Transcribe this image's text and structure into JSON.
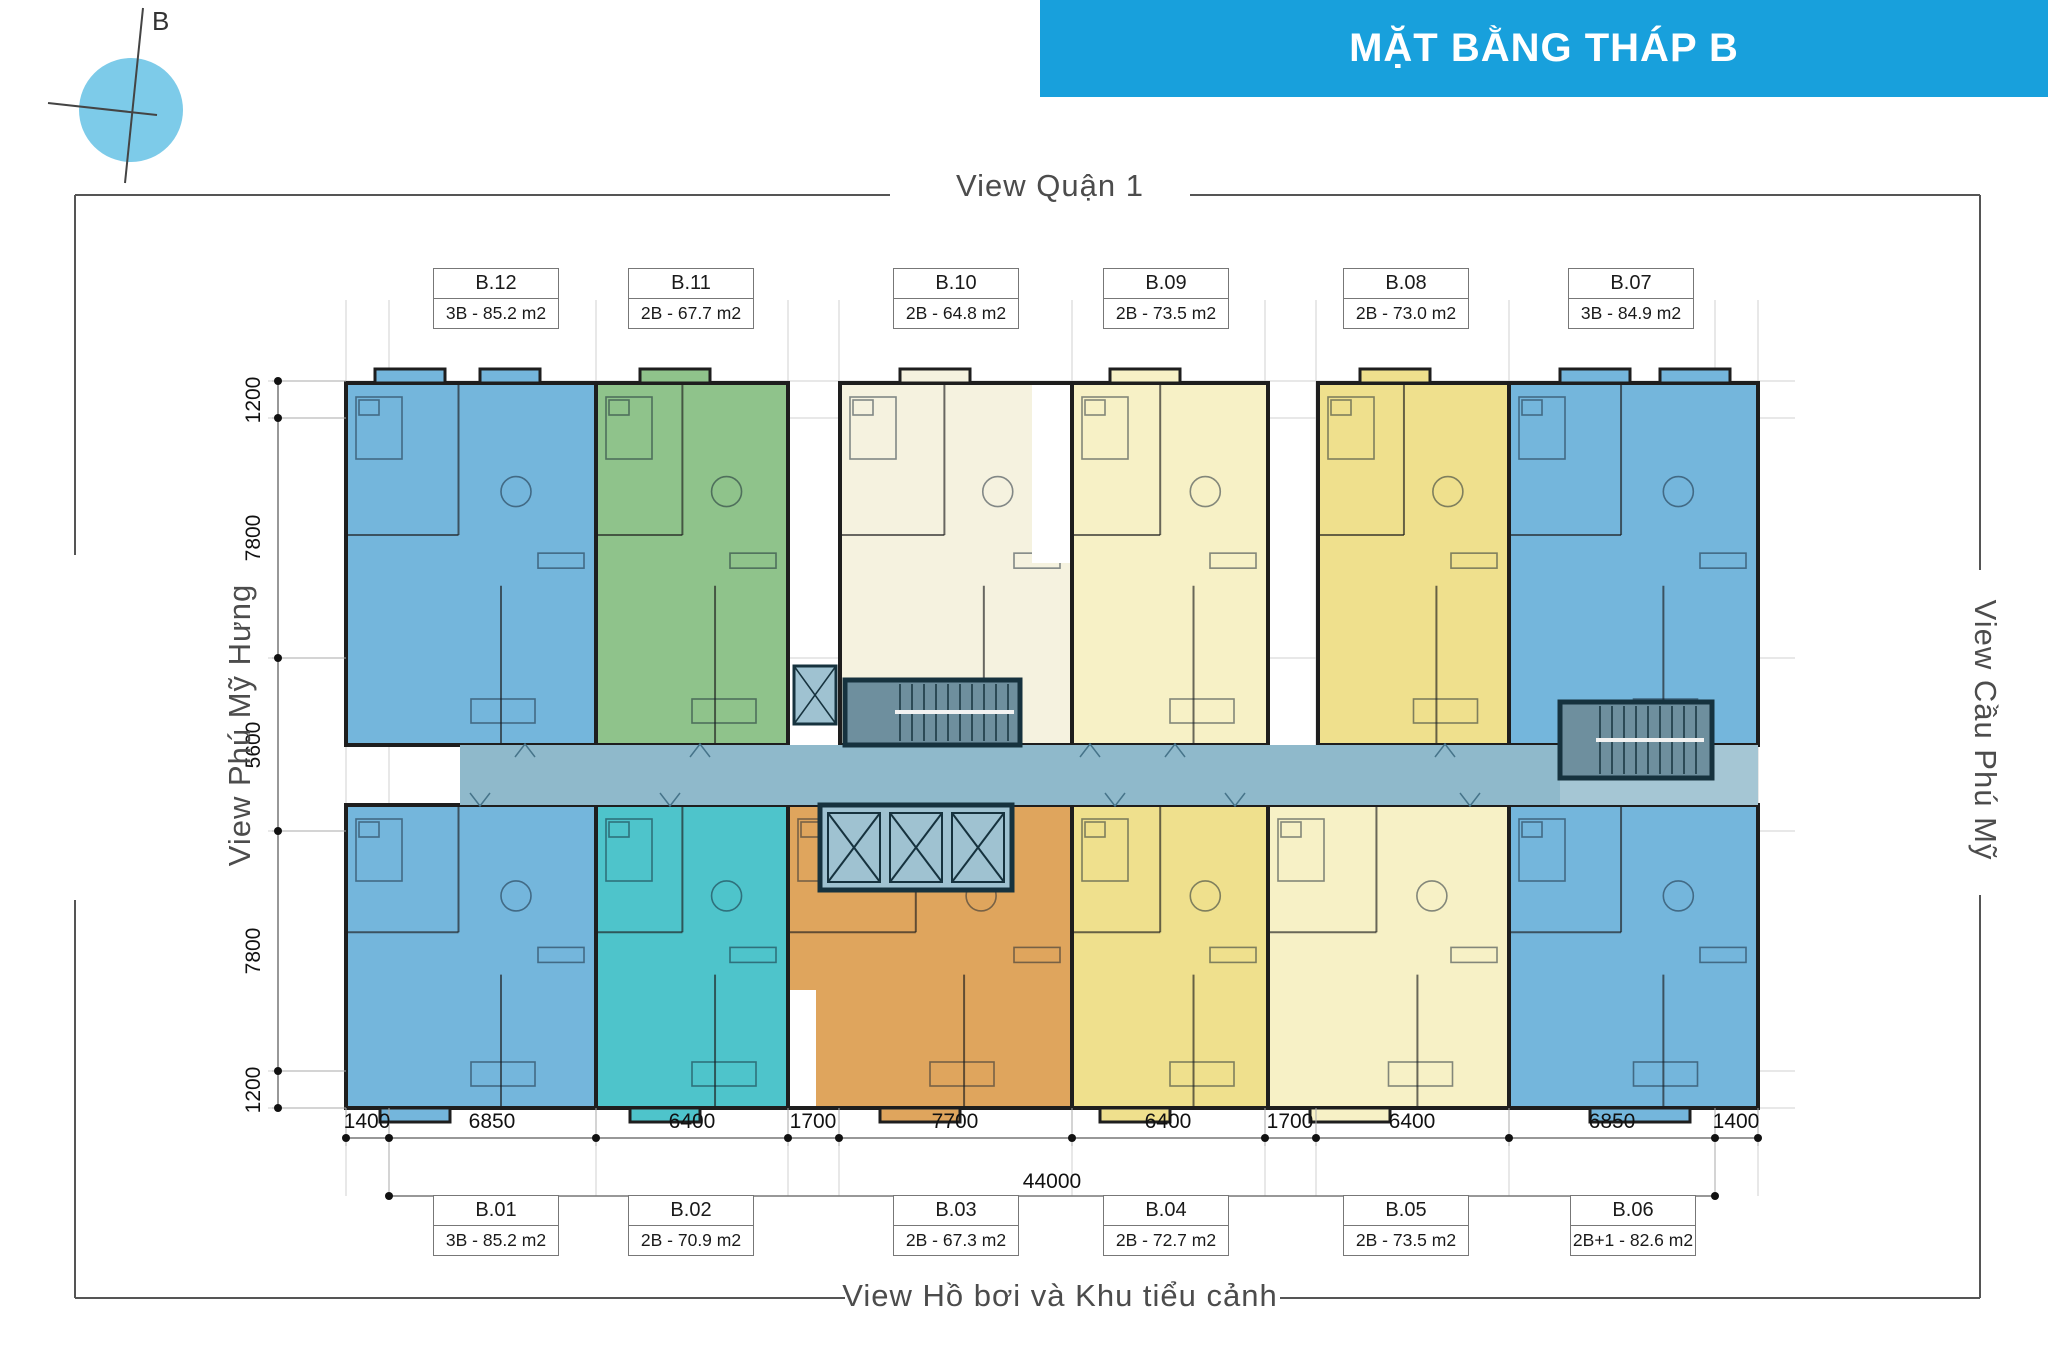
{
  "banner": {
    "title": "MẶT BẰNG THÁP B"
  },
  "compass": {
    "label": "B"
  },
  "views": {
    "top": "View Quận 1",
    "left": "View Phú Mỹ Hưng",
    "right": "View Cầu Phú Mỹ",
    "bottom": "View Hồ bơi và Khu tiểu cảnh"
  },
  "units": [
    {
      "id": "B.12",
      "spec": "3B - 85.2 m2"
    },
    {
      "id": "B.11",
      "spec": "2B - 67.7 m2"
    },
    {
      "id": "B.10",
      "spec": "2B - 64.8 m2"
    },
    {
      "id": "B.09",
      "spec": "2B - 73.5 m2"
    },
    {
      "id": "B.08",
      "spec": "2B - 73.0 m2"
    },
    {
      "id": "B.07",
      "spec": "3B - 84.9 m2"
    },
    {
      "id": "B.01",
      "spec": "3B - 85.2 m2"
    },
    {
      "id": "B.02",
      "spec": "2B - 70.9 m2"
    },
    {
      "id": "B.03",
      "spec": "2B - 67.3 m2"
    },
    {
      "id": "B.04",
      "spec": "2B - 72.7 m2"
    },
    {
      "id": "B.05",
      "spec": "2B - 73.5 m2"
    },
    {
      "id": "B.06",
      "spec": "2B+1 - 82.6 m2"
    }
  ],
  "dims": {
    "bottom": [
      "1400",
      "6850",
      "6400",
      "1700",
      "7700",
      "6400",
      "1700",
      "6400",
      "6850",
      "1400"
    ],
    "total": "44000",
    "left": [
      "1200",
      "7800",
      "5600",
      "7800",
      "1200"
    ]
  },
  "colors": {
    "banner": "#18A0DC",
    "compass": "#7DCBE9",
    "blue": "#74B6DC",
    "green": "#8FC38B",
    "cream": "#F5F2DF",
    "paleYellow": "#F7F1C6",
    "yellow": "#EFE08D",
    "teal": "#4EC4CB",
    "orange": "#DFA55D",
    "corridor": "#8FB9CB",
    "corridorLight": "#A5C6D4",
    "core": "#6E8F9E",
    "lift": "#9FC2D1",
    "wall": "#1E1E1E"
  }
}
